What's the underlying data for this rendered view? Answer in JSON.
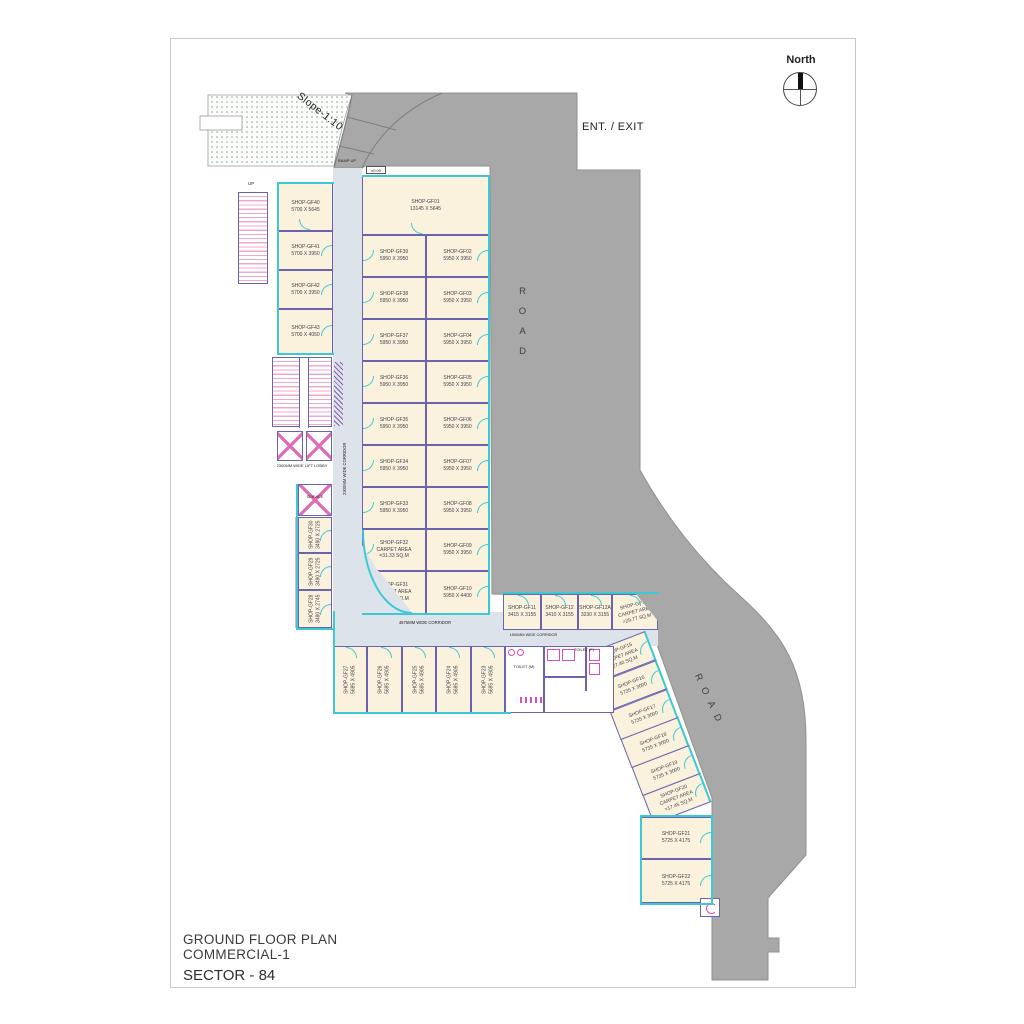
{
  "sheet": {
    "title_lines": [
      "GROUND FLOOR PLAN",
      "COMMERCIAL-1",
      "SECTOR - 84"
    ]
  },
  "compass": {
    "label": "North"
  },
  "annotations": {
    "ent_exit": "ENT. / EXIT",
    "slope": "Slope-1:10",
    "road": "ROAD",
    "ramp_up": "RAMP UP",
    "up": "UP",
    "level_marker": "±0.00",
    "lift_lobby": "2300MM WIDE LIFT LOBBY",
    "corridor_vertical": "2300MM WIDE CORRIDOR",
    "corridor_horizontal": "4675MM WIDE CORRIDOR",
    "corridor_small": "1500MM WIDE CORRIDOR",
    "toilet_m": "TOILET (M)",
    "toilet_f": "TOILET (F)",
    "service_lift": "SERVICE"
  },
  "colors": {
    "road": "#a8a8a8",
    "wall_outer": "#3cc9d3",
    "wall_inner": "#6b64ad",
    "shop_fill": "#faf2dd",
    "corridor_fill": "#dde3ea",
    "stair_pink": "#f0a8cc",
    "fixture_pink": "#d94fb5",
    "slope_dots_green": "#74a874"
  },
  "shops": {
    "gf40": {
      "lines": [
        "SHOP-GF40",
        "5700 X 5645"
      ]
    },
    "gf01": {
      "lines": [
        "SHOP-GF01",
        "13145 X 5645"
      ]
    },
    "left_column": [
      {
        "lines": [
          "SHOP-GF41",
          "5700 X 3950"
        ]
      },
      {
        "lines": [
          "SHOP-GF42",
          "5700 X 3950"
        ]
      },
      {
        "lines": [
          "SHOP-GF43",
          "5700 X 4050"
        ]
      }
    ],
    "middle_column": [
      {
        "lines": [
          "SHOP-GF39",
          "5950 X 3950"
        ]
      },
      {
        "lines": [
          "SHOP-GF38",
          "5950 X 3950"
        ]
      },
      {
        "lines": [
          "SHOP-GF37",
          "5950 X 3950"
        ]
      },
      {
        "lines": [
          "SHOP-GF36",
          "5950 X 3950"
        ]
      },
      {
        "lines": [
          "SHOP-GF35",
          "5950 X 3950"
        ]
      },
      {
        "lines": [
          "SHOP-GF34",
          "5950 X 3950"
        ]
      },
      {
        "lines": [
          "SHOP-GF33",
          "5950 X 3950"
        ]
      },
      {
        "lines": [
          "SHOP-GF32",
          "CARPET AREA",
          "=31.33 SQ.M"
        ]
      },
      {
        "lines": [
          "SHOP-GF31",
          "CARPET AREA",
          "=15.89 SQ.M"
        ]
      }
    ],
    "right_column": [
      {
        "lines": [
          "SHOP-GF02",
          "5950 X 3950"
        ]
      },
      {
        "lines": [
          "SHOP-GF03",
          "5950 X 3950"
        ]
      },
      {
        "lines": [
          "SHOP-GF04",
          "5950 X 3950"
        ]
      },
      {
        "lines": [
          "SHOP-GF05",
          "5950 X 3950"
        ]
      },
      {
        "lines": [
          "SHOP-GF06",
          "5950 X 3950"
        ]
      },
      {
        "lines": [
          "SHOP-GF07",
          "5950 X 3950"
        ]
      },
      {
        "lines": [
          "SHOP-GF08",
          "5950 X 3950"
        ]
      },
      {
        "lines": [
          "SHOP-GF09",
          "5950 X 3950"
        ]
      },
      {
        "lines": [
          "SHOP-GF10",
          "5950 X 4400"
        ]
      }
    ],
    "service_column": [
      {
        "lines": [
          "SHOP-GF30",
          "3490 X 2725"
        ]
      },
      {
        "lines": [
          "SHOP-GF29",
          "3490 X 2725"
        ]
      },
      {
        "lines": [
          "SHOP-GF28",
          "3480 X 2745"
        ]
      }
    ],
    "bottom_row": [
      {
        "lines": [
          "SHOP-GF27",
          "5685 X 4905"
        ]
      },
      {
        "lines": [
          "SHOP-GF26",
          "5685 X 4905"
        ]
      },
      {
        "lines": [
          "SHOP-GF25",
          "5685 X 4905"
        ]
      },
      {
        "lines": [
          "SHOP-GF24",
          "5685 X 4905"
        ]
      },
      {
        "lines": [
          "SHOP-GF23",
          "5685 X 4905"
        ]
      }
    ],
    "small_row": [
      {
        "lines": [
          "SHOP-GF11",
          "3415 X 3155"
        ]
      },
      {
        "lines": [
          "SHOP-GF12",
          "3410 X 3155"
        ]
      },
      {
        "lines": [
          "SHOP-GF12A",
          "3230 X 3155"
        ]
      },
      {
        "lines": [
          "SHOP-GF14",
          "CARPET AREA",
          "=29.77 SQ.M"
        ]
      }
    ],
    "diagonal_row": [
      {
        "lines": [
          "SHOP-GF15",
          "CARPET AREA",
          "=27.40 SQ.M"
        ]
      },
      {
        "lines": [
          "SHOP-GF16",
          "5735 X 3000"
        ]
      },
      {
        "lines": [
          "SHOP-GF17",
          "5735 X 3000"
        ]
      },
      {
        "lines": [
          "SHOP-GF18",
          "5735 X 3000"
        ]
      },
      {
        "lines": [
          "SHOP-GF19",
          "5735 X 3000"
        ]
      },
      {
        "lines": [
          "SHOP-GF20",
          "CARPET AREA",
          "=17.45 SQ.M"
        ]
      }
    ],
    "bottom_right_column": [
      {
        "lines": [
          "SHOP-GF21",
          "5725 X 4175"
        ]
      },
      {
        "lines": [
          "SHOP-GF22",
          "5725 X 4175"
        ]
      }
    ]
  }
}
